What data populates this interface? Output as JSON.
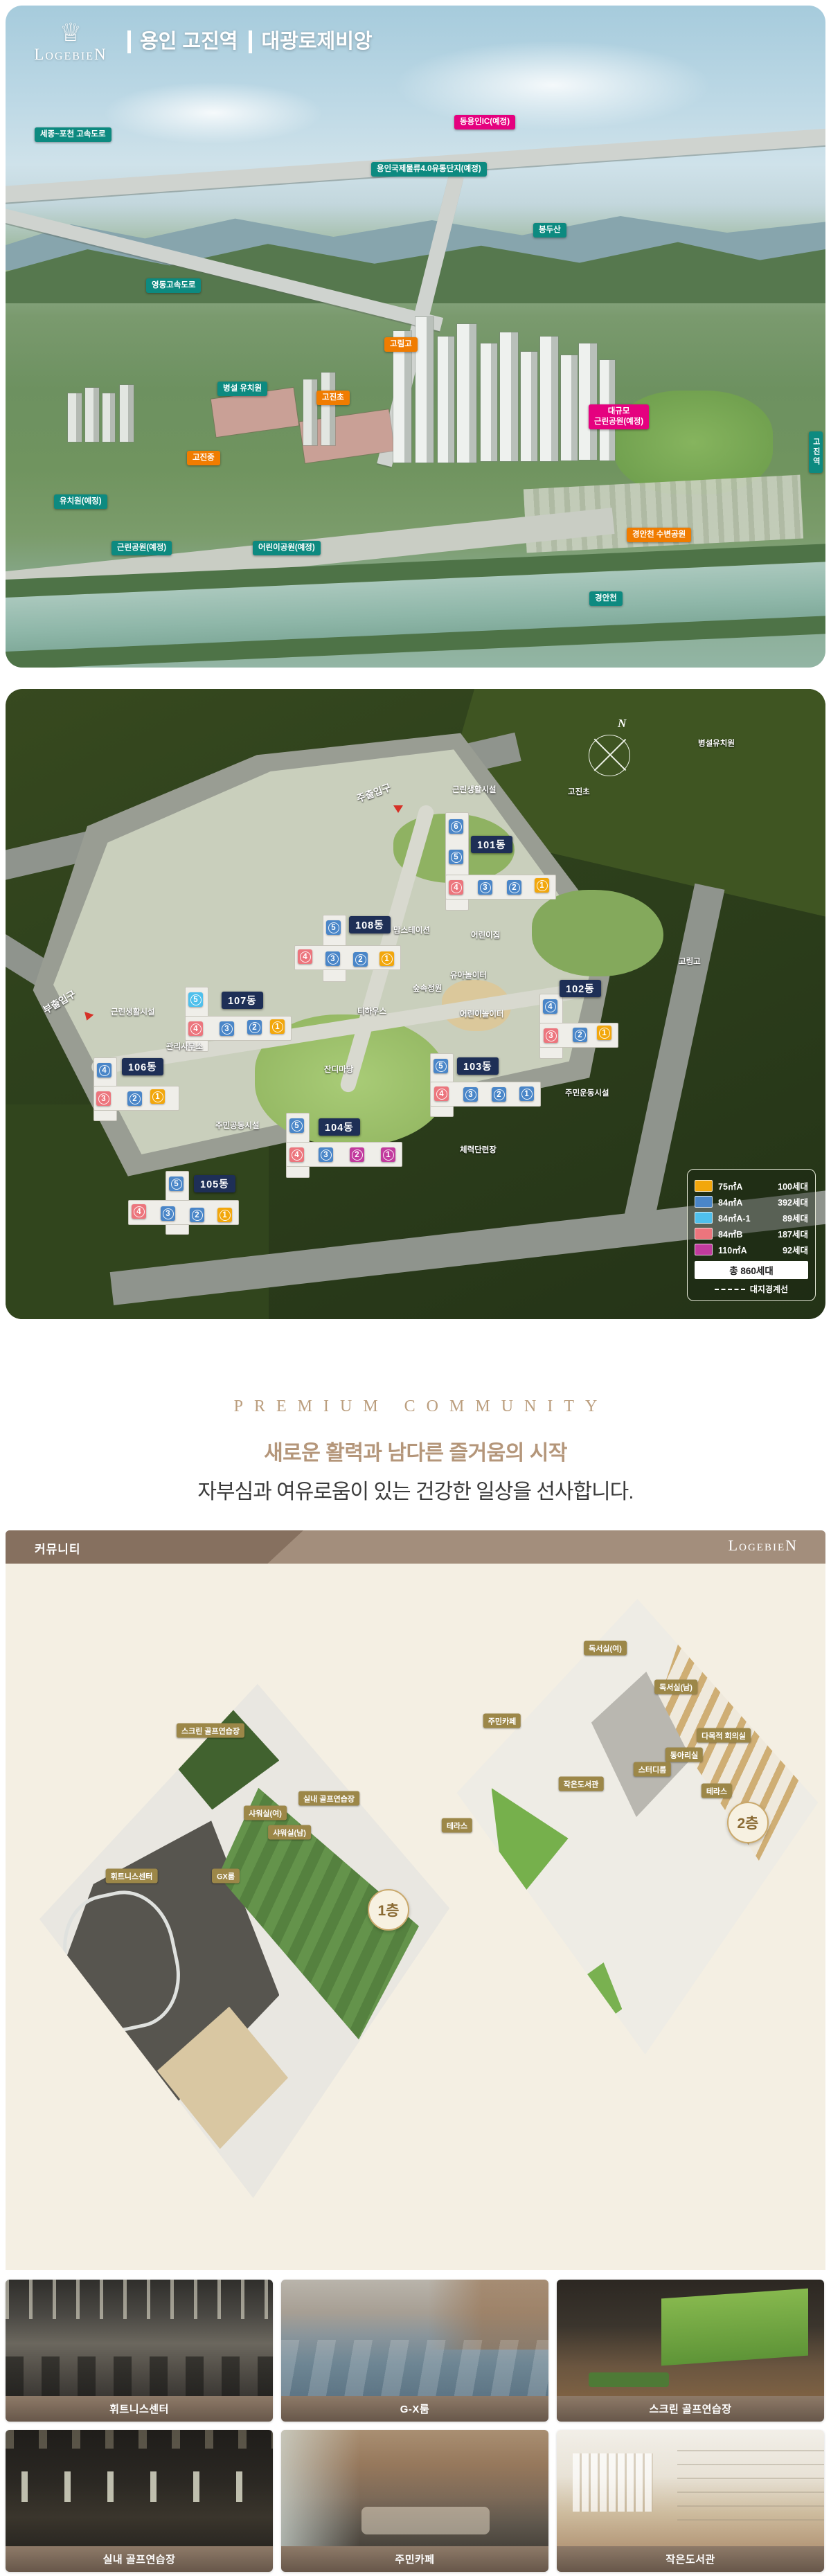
{
  "brand": {
    "name": "LogebieN",
    "crown": "♕"
  },
  "hero": {
    "title_area": "용인 고진역",
    "title_brand": "대광로제비앙",
    "labels": [
      {
        "text": "세종~포천 고속도로"
      },
      {
        "text": "동용인IC(예정)"
      },
      {
        "text": "용인국제물류4.0유통단지(예정)"
      },
      {
        "text": "봉두산"
      },
      {
        "text": "영동고속도로"
      },
      {
        "text": "고림고"
      },
      {
        "text": "병설 유치원"
      },
      {
        "text": "고진초"
      },
      {
        "text": "고진중"
      },
      {
        "text": "대규모\n근린공원(예정)"
      },
      {
        "text": "유치원(예정)"
      },
      {
        "text": "근린공원(예정)"
      },
      {
        "text": "어린이공원(예정)"
      },
      {
        "text": "경안천 수변공원"
      },
      {
        "text": "경안천"
      },
      {
        "text": "고진역"
      }
    ]
  },
  "siteplan": {
    "compass": "N",
    "labels": [
      {
        "text": "병설유치원"
      },
      {
        "text": "고진초"
      },
      {
        "text": "근린생활시설"
      },
      {
        "text": "주출입구"
      },
      {
        "text": "고림고"
      },
      {
        "text": "부출입구"
      },
      {
        "text": "근린생활시설"
      },
      {
        "text": "관리사무소"
      },
      {
        "text": "맘스테이션"
      },
      {
        "text": "어린이집"
      },
      {
        "text": "유아놀이터"
      },
      {
        "text": "숲속정원"
      },
      {
        "text": "어린이놀이터"
      },
      {
        "text": "티하우스"
      },
      {
        "text": "잔디마당"
      },
      {
        "text": "주민공동시설"
      },
      {
        "text": "주민운동시설"
      },
      {
        "text": "체력단련장"
      }
    ],
    "buildings": [
      {
        "name": "101동",
        "units": [
          {
            "n": "6"
          },
          {
            "n": "5"
          },
          {
            "n": "4"
          },
          {
            "n": "3"
          },
          {
            "n": "2"
          },
          {
            "n": "1"
          }
        ]
      },
      {
        "name": "102동",
        "units": [
          {
            "n": "4"
          },
          {
            "n": "3"
          },
          {
            "n": "2"
          },
          {
            "n": "1"
          }
        ]
      },
      {
        "name": "103동",
        "units": [
          {
            "n": "5"
          },
          {
            "n": "4"
          },
          {
            "n": "3"
          },
          {
            "n": "2"
          },
          {
            "n": "1"
          }
        ]
      },
      {
        "name": "104동",
        "units": [
          {
            "n": "5"
          },
          {
            "n": "4"
          },
          {
            "n": "3"
          },
          {
            "n": "2"
          },
          {
            "n": "1"
          }
        ]
      },
      {
        "name": "105동",
        "units": [
          {
            "n": "5"
          },
          {
            "n": "4"
          },
          {
            "n": "3"
          },
          {
            "n": "2"
          },
          {
            "n": "1"
          }
        ]
      },
      {
        "name": "106동",
        "units": [
          {
            "n": "4"
          },
          {
            "n": "3"
          },
          {
            "n": "2"
          },
          {
            "n": "1"
          }
        ]
      },
      {
        "name": "107동",
        "units": [
          {
            "n": "5"
          },
          {
            "n": "4"
          },
          {
            "n": "3"
          },
          {
            "n": "2"
          },
          {
            "n": "1"
          }
        ]
      },
      {
        "name": "108동",
        "units": [
          {
            "n": "5"
          },
          {
            "n": "4"
          },
          {
            "n": "3"
          },
          {
            "n": "2"
          },
          {
            "n": "1"
          }
        ]
      }
    ],
    "legend": {
      "items": [
        {
          "area": "75㎡A",
          "count": "100세대",
          "color": "#f2a70c"
        },
        {
          "area": "84㎡A",
          "count": "392세대",
          "color": "#4a86c8"
        },
        {
          "area": "84㎡A-1",
          "count": "89세대",
          "color": "#4fc0ec"
        },
        {
          "area": "84㎡B",
          "count": "187세대",
          "color": "#ec757d"
        },
        {
          "area": "110㎡A",
          "count": "92세대",
          "color": "#c23b9e"
        }
      ],
      "total": "총 860세대",
      "boundary": "대지경계선"
    }
  },
  "premium": {
    "eyebrow": "PREMIUM COMMUNITY",
    "headline": "새로운 활력과 남다른 즐거움의 시작",
    "subline": "자부심과 여유로움이 있는 건강한 일상을 선사합니다."
  },
  "community": {
    "header": {
      "title": "커뮤니티",
      "brand": "LogebieN"
    },
    "floor1": {
      "badge": "1층",
      "rooms": [
        "스크린 골프연습장",
        "실내 골프연습장",
        "샤워실(여)",
        "샤워실(남)",
        "휘트니스센터",
        "GX룸"
      ]
    },
    "floor2": {
      "badge": "2층",
      "rooms": [
        "독서실(여)",
        "독서실(남)",
        "주민카페",
        "다목적 회의실",
        "동아리실",
        "스터디룸",
        "작은도서관",
        "테라스",
        "테라스"
      ]
    },
    "photos": [
      {
        "label": "휘트니스센터"
      },
      {
        "label": "G-X룸"
      },
      {
        "label": "스크린 골프연습장"
      },
      {
        "label": "실내 골프연습장"
      },
      {
        "label": "주민카페"
      },
      {
        "label": "작은도서관"
      }
    ]
  },
  "colors": {
    "badge_teal": "#0d8a80",
    "badge_orange": "#f07c00",
    "badge_pink": "#e5017f",
    "unit_blue": "#4a86c8",
    "unit_lightblue": "#4fc0ec",
    "unit_salmon": "#ec757d",
    "unit_orange": "#f2a70c",
    "unit_magenta": "#c23b9e",
    "brand_brown": "#b4967a",
    "header_brown": "#a38e7c",
    "cream": "#f4efe3",
    "building_badge_navy": "#1e2f56"
  }
}
